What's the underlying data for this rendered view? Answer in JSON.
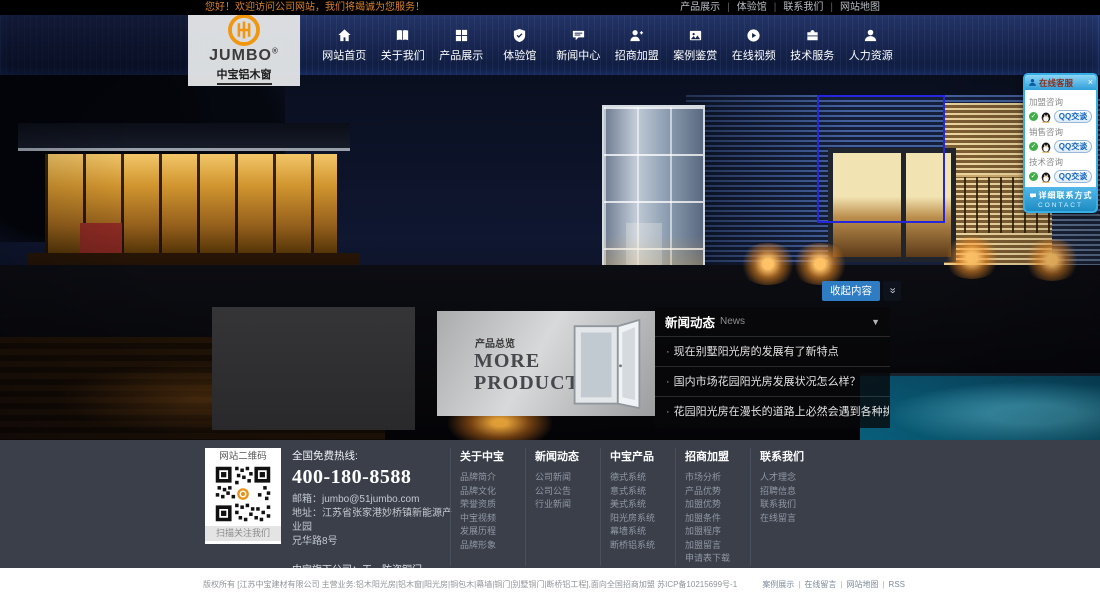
{
  "topbar": {
    "welcome": "您好！欢迎访问公司网站，我们将竭诚为您服务！",
    "links": [
      "产品展示",
      "体验馆",
      "联系我们",
      "网站地图"
    ]
  },
  "logo": {
    "brand": "JUMBO",
    "reg": "®",
    "subtitle": "中宝铝木窗"
  },
  "nav": {
    "items": [
      {
        "label": "网站首页",
        "icon": "home"
      },
      {
        "label": "关于我们",
        "icon": "book"
      },
      {
        "label": "产品展示",
        "icon": "grid"
      },
      {
        "label": "体验馆",
        "icon": "shield"
      },
      {
        "label": "新闻中心",
        "icon": "chat"
      },
      {
        "label": "招商加盟",
        "icon": "user-plus"
      },
      {
        "label": "案例鉴赏",
        "icon": "photo"
      },
      {
        "label": "在线视频",
        "icon": "play"
      },
      {
        "label": "技术服务",
        "icon": "briefcase"
      },
      {
        "label": "人力资源",
        "icon": "user"
      }
    ]
  },
  "qq": {
    "title": "在线客服",
    "close": "×",
    "groups": [
      {
        "label": "加盟咨询",
        "button": "QQ交谈"
      },
      {
        "label": "销售咨询",
        "button": "QQ交谈"
      },
      {
        "label": "技术咨询",
        "button": "QQ交谈"
      }
    ],
    "contact_label": "详细联系方式",
    "contact_sub": "CONTACT"
  },
  "hero": {
    "collapse_label": "收起内容",
    "collapse_icon_glyph": "»"
  },
  "news": {
    "title": "新闻动态",
    "subtitle": "News",
    "caret": "▼",
    "items": [
      "现在别墅阳光房的发展有了新特点",
      "国内市场花园阳光房发展状况怎么样？",
      "花园阳光房在漫长的道路上必然会遇到各种挑战"
    ]
  },
  "products": {
    "overview_label": "产品总览",
    "more_title": "MORE PRODUCTS"
  },
  "footer": {
    "qr": {
      "title": "网站二维码",
      "caption": "扫描关注我们"
    },
    "hotline_label": "全国免费热线:",
    "hotline_number": "400-180-8588",
    "email_line": "邮箱：jumbo@51jumbo.com",
    "address_line1": "地址：江苏省张家港妙桥镇新能源产业园",
    "address_line2": "兄华路8号",
    "subsidiary_line": "中宝旗下公司：天一防盗铜门",
    "columns": [
      {
        "title": "关于中宝",
        "links": [
          "品牌简介",
          "品牌文化",
          "荣誉资质",
          "中宝视频",
          "发展历程",
          "品牌形象"
        ]
      },
      {
        "title": "新闻动态",
        "links": [
          "公司新闻",
          "公司公告",
          "行业新闻"
        ]
      },
      {
        "title": "中宝产品",
        "links": [
          "德式系统",
          "意式系统",
          "美式系统",
          "阳光房系统",
          "幕墙系统",
          "断桥铝系统"
        ]
      },
      {
        "title": "招商加盟",
        "links": [
          "市场分析",
          "产品优势",
          "加盟优势",
          "加盟条件",
          "加盟程序",
          "加盟留言",
          "申请表下载"
        ]
      },
      {
        "title": "联系我们",
        "links": [
          "人才理念",
          "招聘信息",
          "联系我们",
          "在线留言"
        ]
      }
    ]
  },
  "bottombar": {
    "copyright": "版权所有 [江苏中宝建材有限公司 主营业务:铝木阳光房|铝木窗|阳光房|铜包木|幕墙|铜门|别墅铜门|断桥铝工程],面向全国招商加盟 苏ICP备10215699号-1",
    "links": [
      "案例展示",
      "在线留言",
      "网站地图",
      "RSS"
    ]
  },
  "colors": {
    "accent_orange": "#e8921a",
    "welcome_orange": "#d8812a",
    "nav_navy": "#16244e",
    "qq_blue": "#36aee6",
    "collapse_button_blue": "#2e7cc3",
    "footer_bg": "#3a3f4a",
    "highlight_rect_blue": "#2626dd"
  }
}
